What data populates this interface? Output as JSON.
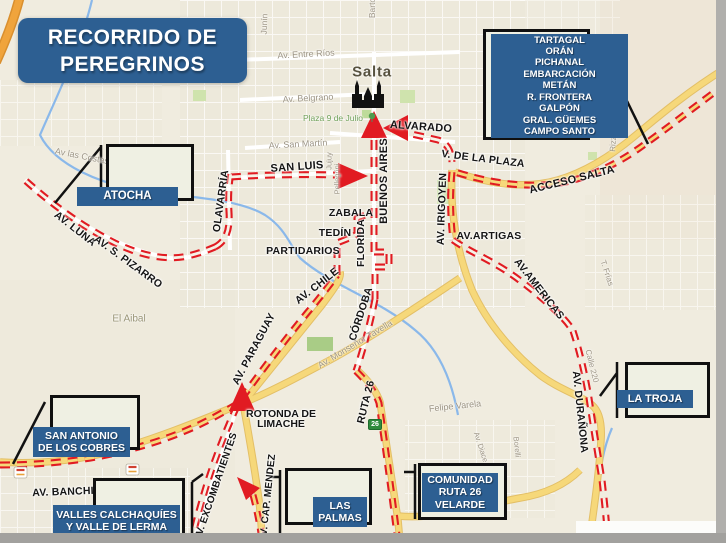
{
  "title": {
    "line1": "RECORRIDO DE",
    "line2": "PEREGRINOS"
  },
  "callouts": {
    "atocha": {
      "label": "ATOCHA"
    },
    "destinations_north": {
      "lines": [
        "TARTAGAL",
        "ORÁN",
        "PICHANAL",
        "EMBARCACIÓN",
        "METÁN",
        "R. FRONTERA",
        "GALPÓN",
        "GRAL. GÜEMES",
        "CAMPO SANTO"
      ]
    },
    "la_troja": {
      "label": "LA TROJA"
    },
    "san_antonio": {
      "line1": "SAN ANTONIO",
      "line2": "DE LOS COBRES"
    },
    "valles": {
      "line1": "VALLES CALCHAQUÍES",
      "line2": "Y VALLE DE LERMA"
    },
    "las_palmas": {
      "line1": "LAS",
      "line2": "PALMAS"
    },
    "comunidad": {
      "line1": "COMUNIDAD",
      "line2": "RUTA 26",
      "line3": "VELARDE"
    }
  },
  "route_labels": {
    "san_luis": "SAN LUIS",
    "alvarado": "ALVARADO",
    "buenos_aires": "BUENOS AIRES",
    "zabala": "ZABALA",
    "tedin": "TEDÍN",
    "partidarios": "PARTIDARIOS",
    "florida": "FLORIDA",
    "cordoba": "CÓRDOBA",
    "av_chile": "AV. CHILE",
    "av_paraguay": "AV. PARAGUAY",
    "av_irigoyen": "AV. IRIGOYEN",
    "av_artigas": "AV.ARTIGAS",
    "av_americas": "AV.AMERICAS",
    "v_de_la_plaza": "V. DE LA PLAZA",
    "acceso_salta": "ACCESO SALTA",
    "av_luna": "AV. LUNA",
    "av_s_pizarro": "AV. S. PIZARRO",
    "olavarria": "OLAVARRÍA",
    "av_duranona": "AV. DURAÑONA",
    "ruta_26": "RUTA 26",
    "rotonda_line1": "ROTONDA DE",
    "rotonda_line2": "LIMACHE",
    "av_excombatientes": "AV. EXCOMBATIENTES",
    "av_cap_mendez": "AV. CAP. MENDEZ",
    "av_banchi": "AV. BANCHI"
  },
  "map_labels": {
    "city": "Salta",
    "plaza": "Plaza 9 de Julio",
    "entre_rios": "Av. Entre Ríos",
    "belgrano": "Av. Belgrano",
    "san_martin": "Av. San Martín",
    "las_costas": "Av las Costas",
    "el_aibal": "El Aibal",
    "tavella": "Av. Monseñor Tavella",
    "felipe_varela": "Felipe Varela",
    "calle_220": "Calle 220",
    "frias": "T. Frías",
    "pellegrini": "Pellegrini",
    "jujuy": "Jujuy",
    "borelli": "Borelli",
    "av_diace": "Av. Diace",
    "rizz": "Rizz",
    "junin": "Junín",
    "barto": "Barto"
  },
  "shields": {
    "ruta26": "26"
  },
  "colors": {
    "accent_blue": "#2d5f92",
    "route_red": "#e11b22",
    "road_yellow": "#f6d87a",
    "map_background": "#f0ecdf"
  }
}
